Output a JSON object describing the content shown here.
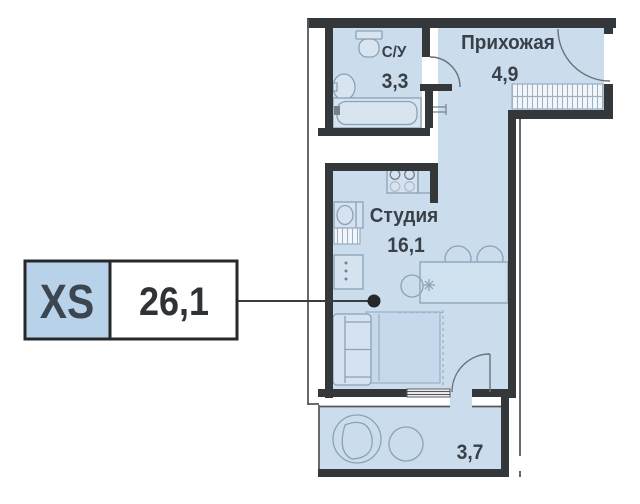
{
  "unit_card": {
    "type_label": "XS",
    "total_area": "26,1"
  },
  "rooms": {
    "bathroom": {
      "name": "С/У",
      "area": "3,3"
    },
    "hallway": {
      "name": "Прихожая",
      "area": "4,9"
    },
    "studio": {
      "name": "Студия",
      "area": "16,1"
    },
    "balcony": {
      "area": "3,7"
    }
  },
  "colors": {
    "room_fill": "#cbdded",
    "wall": "#35383b",
    "furniture_stroke": "#8aa1b6",
    "card_fill": "#b7d2e9",
    "text": "#3a4047"
  }
}
